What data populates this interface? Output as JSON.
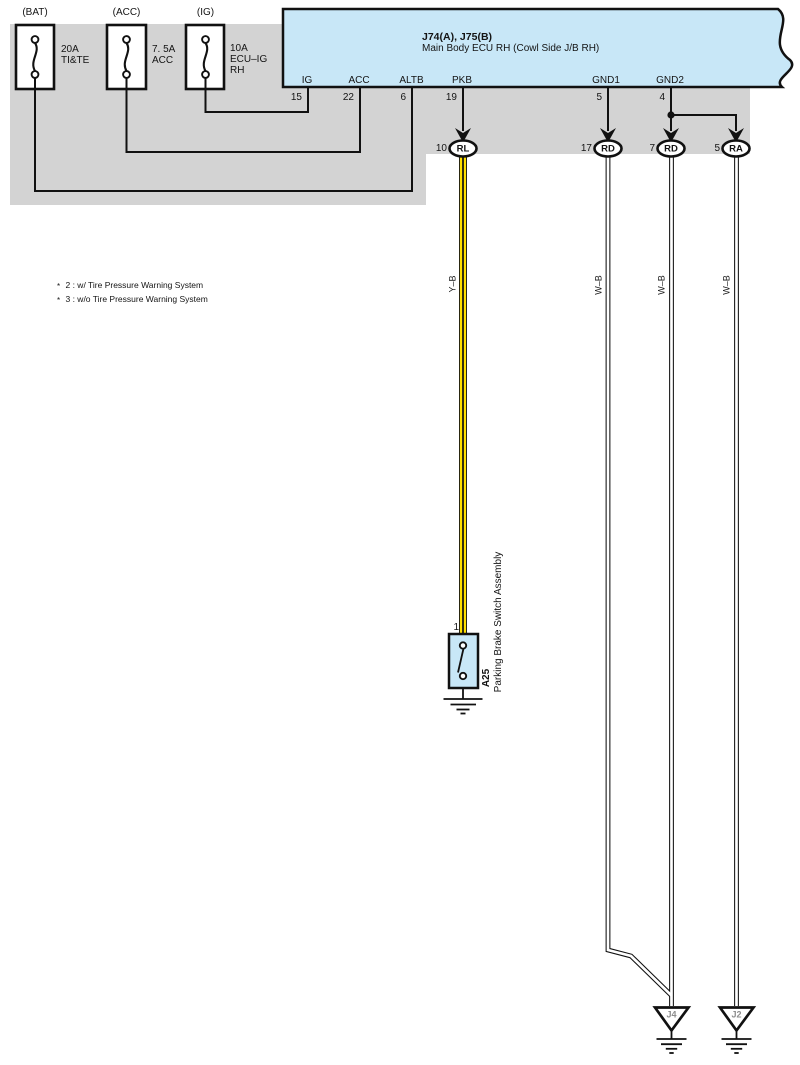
{
  "fuses": [
    {
      "terminal": "(BAT)",
      "rating": "20A",
      "circuit": "TI&TE"
    },
    {
      "terminal": "(ACC)",
      "rating": "7. 5A",
      "circuit": "ACC"
    },
    {
      "terminal": "(IG)",
      "rating": "10A",
      "circuit": "ECU–IG",
      "circuit_line2": "RH"
    }
  ],
  "ecu": {
    "code": "J74(A), J75(B)",
    "name": "Main Body ECU RH (Cowl Side J/B RH)",
    "pins": [
      {
        "label": "IG",
        "number": "15"
      },
      {
        "label": "ACC",
        "number": "22"
      },
      {
        "label": "ALTB",
        "number": "6"
      },
      {
        "label": "PKB",
        "number": "19"
      },
      {
        "label": "GND1",
        "number": "5"
      },
      {
        "label": "GND2",
        "number": "4"
      }
    ]
  },
  "connectors": [
    {
      "number": "10",
      "code": "RL"
    },
    {
      "number": "17",
      "code": "RD"
    },
    {
      "number": "7",
      "code": "RD"
    },
    {
      "number": "5",
      "code": "RA"
    }
  ],
  "wires": [
    {
      "label": "Y–B"
    },
    {
      "label": "W–B"
    },
    {
      "label": "W–B"
    },
    {
      "label": "W–B"
    }
  ],
  "notes": [
    {
      "marker": "*",
      "text": "2 : w/ Tire Pressure Warning System"
    },
    {
      "marker": "*",
      "text": "3 : w/o Tire Pressure Warning System"
    }
  ],
  "switch": {
    "pin": "1",
    "code": "A25",
    "name": "Parking Brake Switch Assembly"
  },
  "grounds": [
    {
      "label": "J4"
    },
    {
      "label": "J2"
    }
  ],
  "colors": {
    "ecu_fill": "#c8e7f7",
    "band_fill": "#d3d3d3",
    "wire_yellow": "#ffdf00",
    "ground_label": "#8d8d8d"
  }
}
